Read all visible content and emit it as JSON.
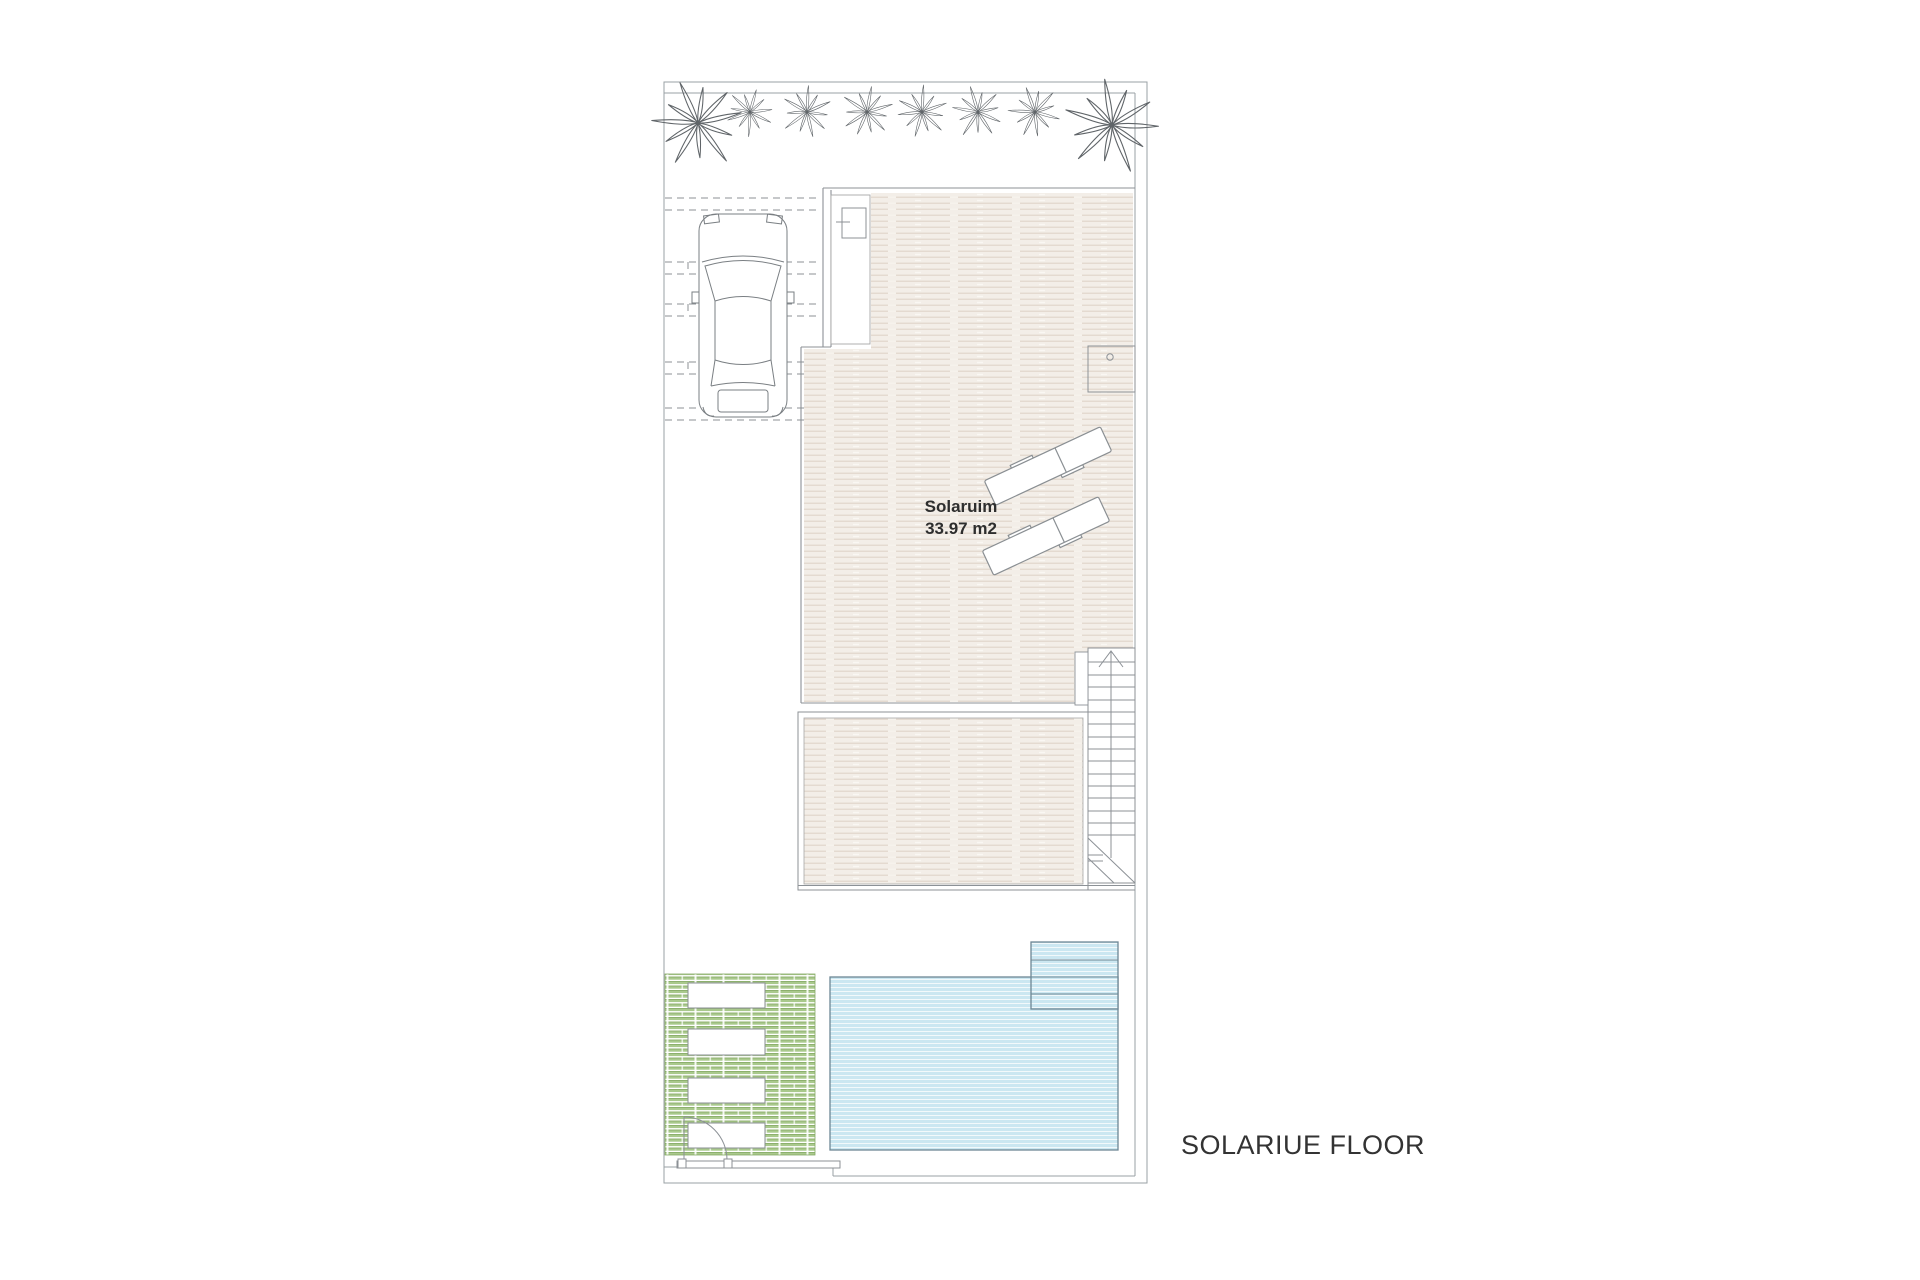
{
  "title": {
    "floor_label": "SOLARIUE FLOOR"
  },
  "solarium": {
    "name": "Solaruim",
    "area": "33.97 m2"
  },
  "plan": {
    "colors": {
      "boundary_line": "#9aa0a4",
      "wall_line": "#8c9196",
      "deck_plank_line": "#e2d8cd",
      "deck_background": "#f3eee8",
      "pool_fill": "#cbe7f1",
      "pool_border": "#6e8794",
      "green_deck": "#a9c98c",
      "green_deck_edge": "#86aa66",
      "drawing_line": "#7a7f83",
      "text": "#333333"
    },
    "element_counts": {
      "palm_trees": 8,
      "sun_loungers": 2,
      "planters": 4,
      "pool_steps": 4,
      "stair_treads": 15,
      "parking_mark_rows": 5,
      "cars": 1
    },
    "icons": [
      "palm-tree-icon",
      "car-icon",
      "sun-lounger-icon",
      "staircase-icon",
      "up-arrow-icon",
      "pool-icon",
      "pool-steps-icon",
      "door-swing-icon",
      "planter-icon",
      "shower-fixture-icon"
    ]
  }
}
